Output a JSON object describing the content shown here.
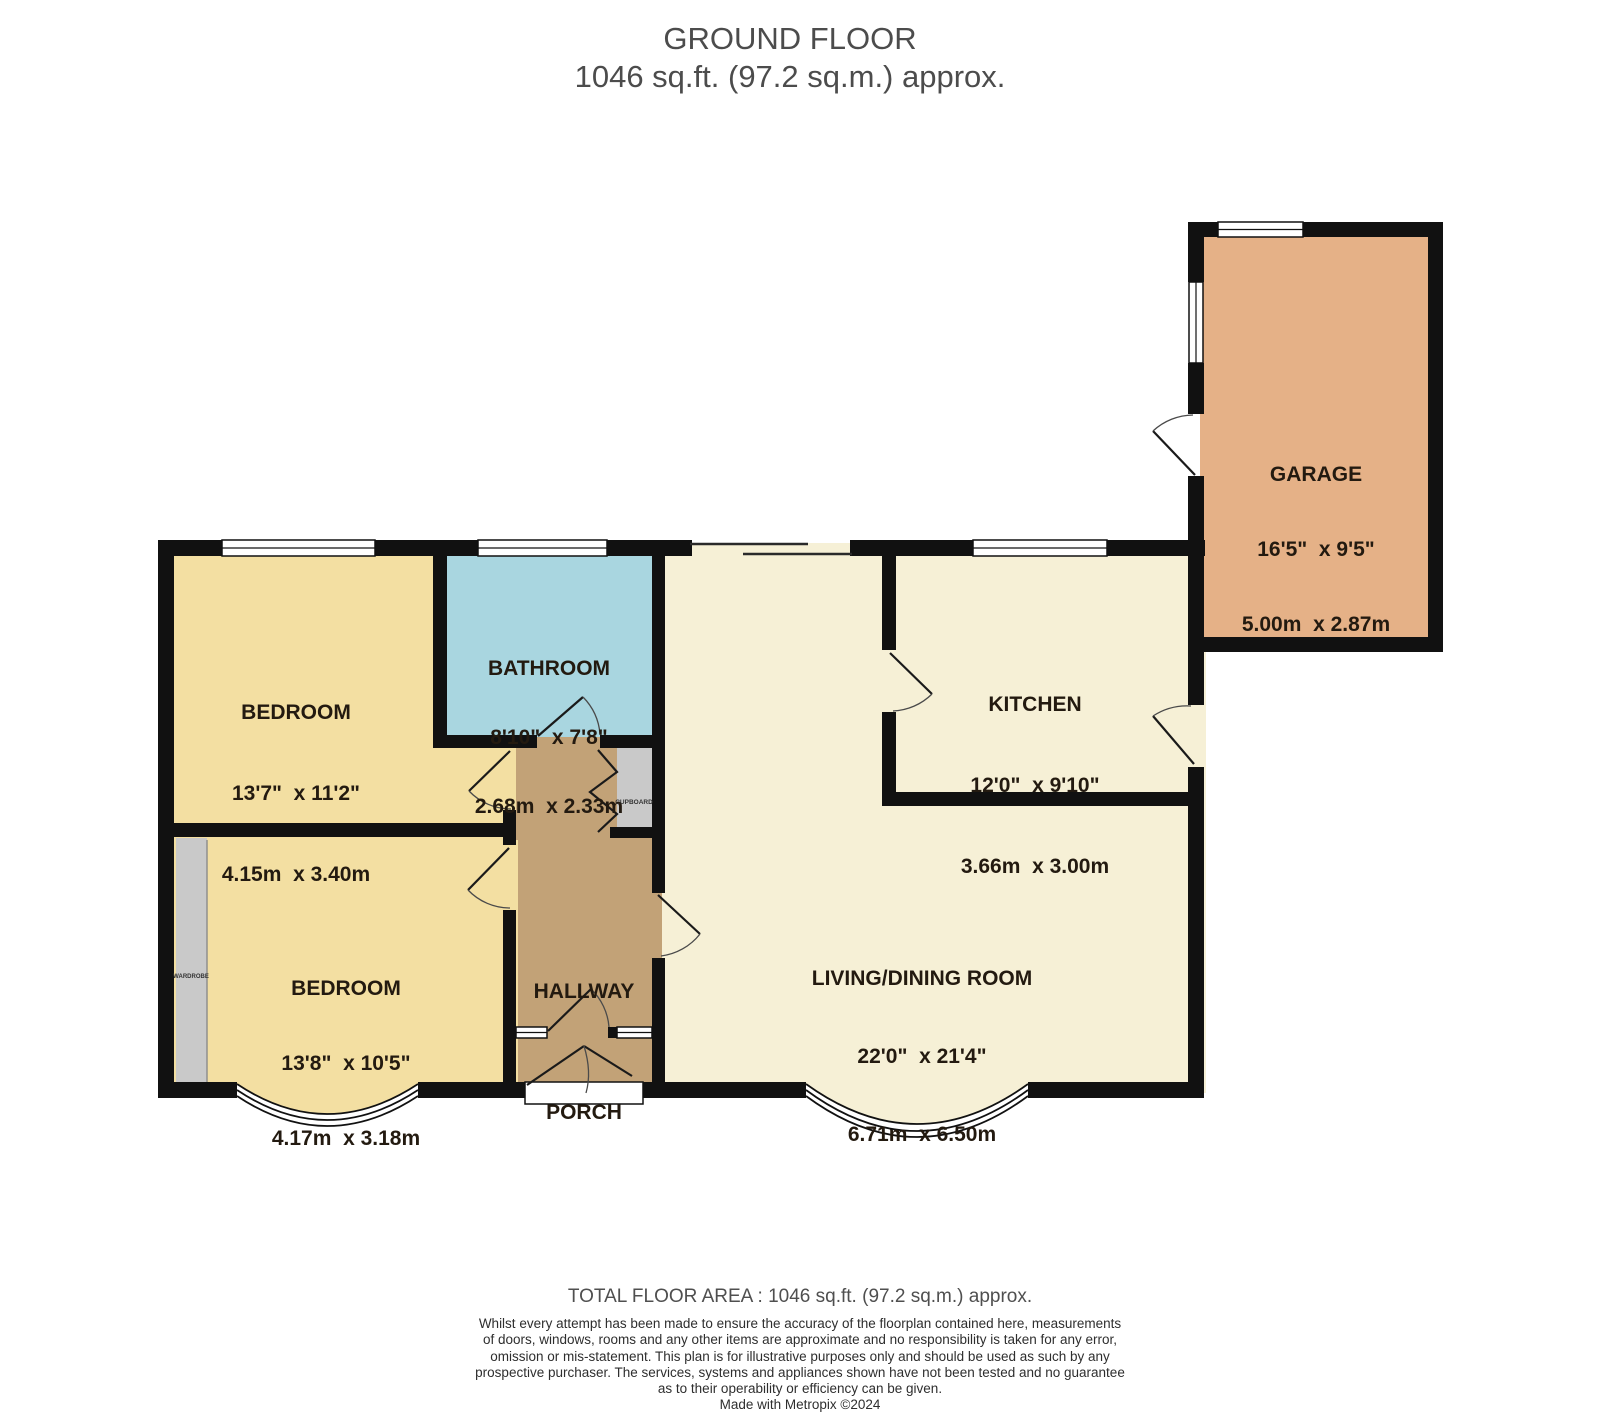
{
  "title": {
    "line1": "GROUND FLOOR",
    "line2": "1046 sq.ft. (97.2 sq.m.) approx."
  },
  "rooms": {
    "garage": {
      "name": "GARAGE",
      "imperial": "16'5\"  x 9'5\"",
      "metric": "5.00m  x 2.87m"
    },
    "bedroom1": {
      "name": "BEDROOM",
      "imperial": "13'7\"  x 11'2\"",
      "metric": "4.15m  x 3.40m"
    },
    "bathroom": {
      "name": "BATHROOM",
      "imperial": "8'10\"  x 7'8\"",
      "metric": "2.68m  x 2.33m"
    },
    "kitchen": {
      "name": "KITCHEN",
      "imperial": "12'0\"  x 9'10\"",
      "metric": "3.66m  x 3.00m"
    },
    "living": {
      "name": "LIVING/DINING ROOM",
      "imperial": "22'0\"  x 21'4\"",
      "metric": "6.71m  x 6.50m"
    },
    "bedroom2": {
      "name": "BEDROOM",
      "imperial": "13'8\"  x 10'5\"",
      "metric": "4.17m  x 3.18m"
    },
    "hallway": {
      "name": "HALLWAY"
    },
    "porch": {
      "name": "PORCH"
    },
    "cupboard": {
      "name": "CUPBOARD"
    },
    "wardrobe": {
      "name": "WARDROBE"
    }
  },
  "colors": {
    "wall": "#111111",
    "bedroom": "#f3dfa2",
    "bathroom": "#a9d6e0",
    "kitchen_living": "#f6f0d6",
    "hallway_porch": "#c2a277",
    "garage": "#e5b187",
    "storage": "#c9c9c9",
    "outside": "#ffffff"
  },
  "footer": {
    "total": "TOTAL FLOOR AREA : 1046 sq.ft. (97.2 sq.m.) approx.",
    "disclaimer_lines": [
      "Whilst every attempt has been made to ensure the accuracy of the floorplan contained here, measurements",
      "of doors, windows, rooms and any other items are approximate and no responsibility is taken for any error,",
      "omission or mis-statement. This plan is for illustrative purposes only and should be used as such by any",
      "prospective purchaser. The services, systems and appliances shown have not been tested and no guarantee",
      "as to their operability or efficiency can be given."
    ],
    "credit": "Made with Metropix ©2024"
  }
}
